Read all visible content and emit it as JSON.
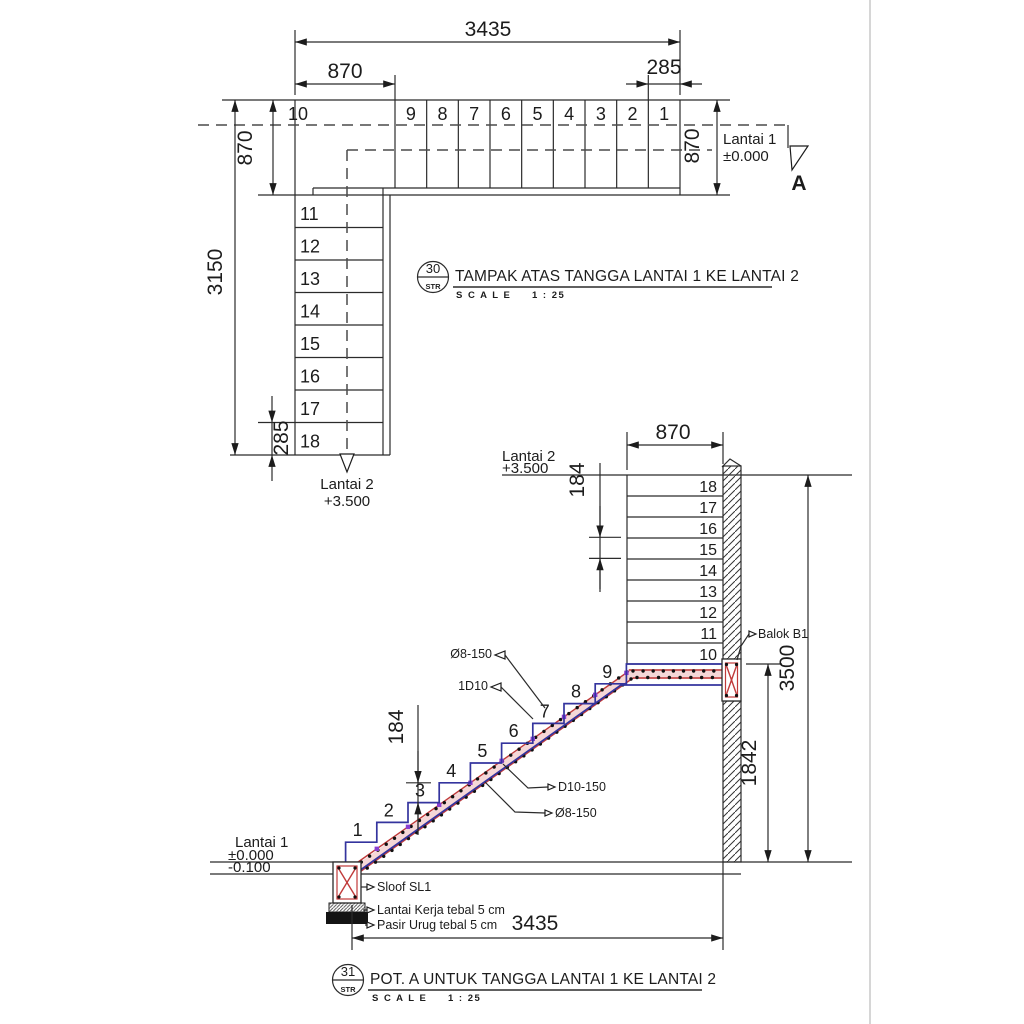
{
  "drawing": {
    "plan": {
      "callout": {
        "number": "30",
        "dept": "STR"
      },
      "title": "TAMPAK ATAS TANGGA LANTAI 1 KE LANTAI 2",
      "scale_label": "S C A L E",
      "scale_value": "1 : 25",
      "upper_treads": [
        "10",
        "9",
        "8",
        "7",
        "6",
        "5",
        "4",
        "3",
        "2",
        "1"
      ],
      "lower_treads": [
        "11",
        "12",
        "13",
        "14",
        "15",
        "16",
        "17",
        "18"
      ],
      "dim_total_top": "3435",
      "dim_landing_top": "870",
      "dim_tread_top": "285",
      "dim_width_left": "870",
      "dim_total_left": "3150",
      "dim_tread_left": "285",
      "dim_width_right": "870",
      "level_start": {
        "name": "Lantai 1",
        "elev": "±0.000"
      },
      "level_end": {
        "name": "Lantai 2",
        "elev": "+3.500"
      },
      "section_letter": "A"
    },
    "section": {
      "callout": {
        "number": "31",
        "dept": "STR"
      },
      "title": "POT. A UNTUK TANGGA LANTAI 1 KE LANTAI 2",
      "scale_label": "S C A L E",
      "scale_value": "1 : 25",
      "upper_steps": [
        "18",
        "17",
        "16",
        "15",
        "14",
        "13",
        "12",
        "11",
        "10"
      ],
      "flight_steps": [
        "1",
        "2",
        "3",
        "4",
        "5",
        "6",
        "7",
        "8",
        "9"
      ],
      "dim_landing": "870",
      "dim_riser_upper": "184",
      "dim_riser_lower": "184",
      "dim_height_total": "3500",
      "dim_height_landing": "1842",
      "dim_run_total": "3435",
      "level_top": {
        "name": "Lantai 2",
        "elev": "+3.500"
      },
      "level_bottom": {
        "name": "Lantai 1",
        "elev": "±0.000",
        "elev_below": "-0.100"
      },
      "ann_top_bar": "Ø8-150",
      "ann_extra_bar": "1D10",
      "ann_main_bar": "D10-150",
      "ann_bottom_bar": "Ø8-150",
      "ann_beam": "Balok B1",
      "ann_sloof": "Sloof SL1",
      "ann_lean_concrete": "Lantai Kerja tebal 5 cm",
      "ann_sand_fill": "Pasir Urug tebal 5 cm"
    },
    "colors": {
      "line": "#2b2b2b",
      "concrete_cut_blue": "#34349e",
      "rebar_red": "#c03a3a",
      "rebar_pink": "#f5d7d7",
      "stirrup_purple": "#8a3fd0",
      "photo_edge_gray": "#c9c9c9"
    }
  }
}
